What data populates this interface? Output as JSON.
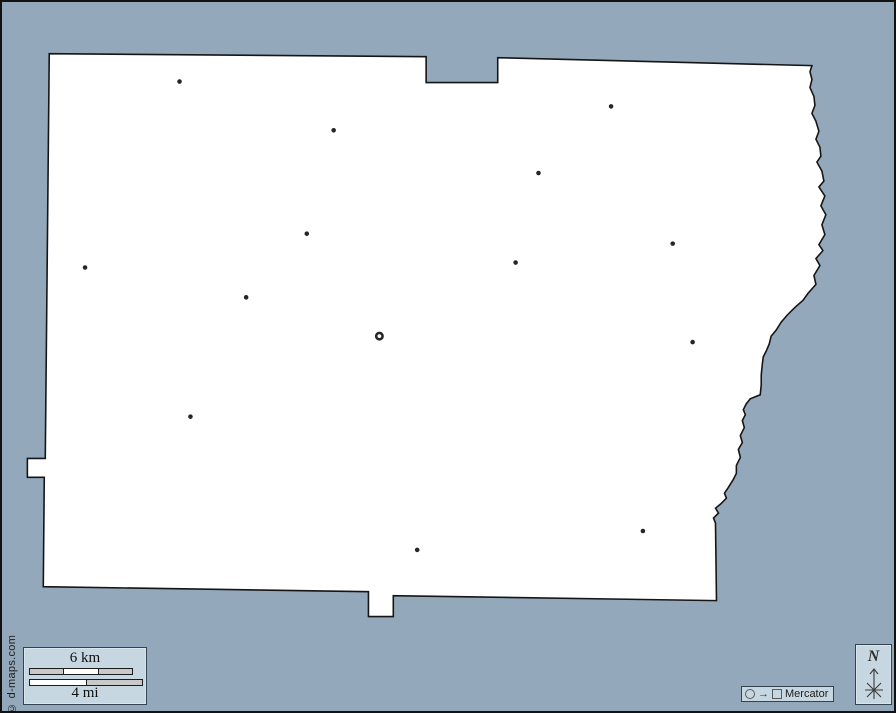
{
  "credit": {
    "text": "© d-maps.com"
  },
  "scale_bar": {
    "km_label": "6 km",
    "mi_label": "4 mi"
  },
  "projection": {
    "name": "Mercator",
    "arrow": "→"
  },
  "north": {
    "label": "N"
  },
  "colors": {
    "background": "#93a9bb",
    "land": "#ffffff",
    "outline": "#151515",
    "panel_fill": "#c6d7e2",
    "panel_border": "#35434e",
    "marker": "#262626",
    "bar_gray": "#c9c9c9",
    "bar_white": "#ffffff"
  },
  "map": {
    "outline": [
      [
        47,
        52
      ],
      [
        426,
        55
      ],
      [
        426,
        81
      ],
      [
        498,
        81
      ],
      [
        498,
        56
      ],
      [
        814,
        64
      ],
      [
        812,
        70
      ],
      [
        814,
        78
      ],
      [
        812,
        86
      ],
      [
        816,
        95
      ],
      [
        817,
        104
      ],
      [
        814,
        112
      ],
      [
        818,
        120
      ],
      [
        821,
        130
      ],
      [
        818,
        138
      ],
      [
        822,
        146
      ],
      [
        823,
        155
      ],
      [
        819,
        161
      ],
      [
        824,
        170
      ],
      [
        826,
        180
      ],
      [
        821,
        186
      ],
      [
        827,
        195
      ],
      [
        823,
        205
      ],
      [
        828,
        214
      ],
      [
        824,
        224
      ],
      [
        827,
        234
      ],
      [
        821,
        244
      ],
      [
        825,
        250
      ],
      [
        818,
        258
      ],
      [
        822,
        265
      ],
      [
        816,
        275
      ],
      [
        818,
        284
      ],
      [
        810,
        293
      ],
      [
        805,
        300
      ],
      [
        797,
        307
      ],
      [
        789,
        315
      ],
      [
        783,
        322
      ],
      [
        778,
        330
      ],
      [
        773,
        336
      ],
      [
        771,
        344
      ],
      [
        768,
        351
      ],
      [
        765,
        357
      ],
      [
        764,
        365
      ],
      [
        763,
        375
      ],
      [
        763,
        385
      ],
      [
        762,
        395
      ],
      [
        752,
        399
      ],
      [
        748,
        404
      ],
      [
        745,
        410
      ],
      [
        747,
        415
      ],
      [
        744,
        421
      ],
      [
        746,
        428
      ],
      [
        742,
        436
      ],
      [
        744,
        443
      ],
      [
        740,
        450
      ],
      [
        742,
        458
      ],
      [
        738,
        466
      ],
      [
        738,
        474
      ],
      [
        735,
        480
      ],
      [
        730,
        488
      ],
      [
        726,
        494
      ],
      [
        728,
        499
      ],
      [
        722,
        505
      ],
      [
        717,
        509
      ],
      [
        720,
        514
      ],
      [
        715,
        519
      ],
      [
        717,
        524
      ],
      [
        718,
        602
      ],
      [
        393,
        597
      ],
      [
        393,
        618
      ],
      [
        368,
        618
      ],
      [
        368,
        593
      ],
      [
        41,
        588
      ],
      [
        42,
        478
      ],
      [
        25,
        478
      ],
      [
        25,
        459
      ],
      [
        43,
        459
      ]
    ],
    "towns": [
      {
        "x": 178,
        "y": 80
      },
      {
        "x": 333,
        "y": 129
      },
      {
        "x": 612,
        "y": 105
      },
      {
        "x": 539,
        "y": 172
      },
      {
        "x": 306,
        "y": 233
      },
      {
        "x": 674,
        "y": 243
      },
      {
        "x": 516,
        "y": 262
      },
      {
        "x": 83,
        "y": 267
      },
      {
        "x": 245,
        "y": 297
      },
      {
        "x": 694,
        "y": 342
      },
      {
        "x": 189,
        "y": 417
      },
      {
        "x": 644,
        "y": 532
      },
      {
        "x": 417,
        "y": 551
      }
    ],
    "county_seat": {
      "x": 379,
      "y": 336
    }
  }
}
